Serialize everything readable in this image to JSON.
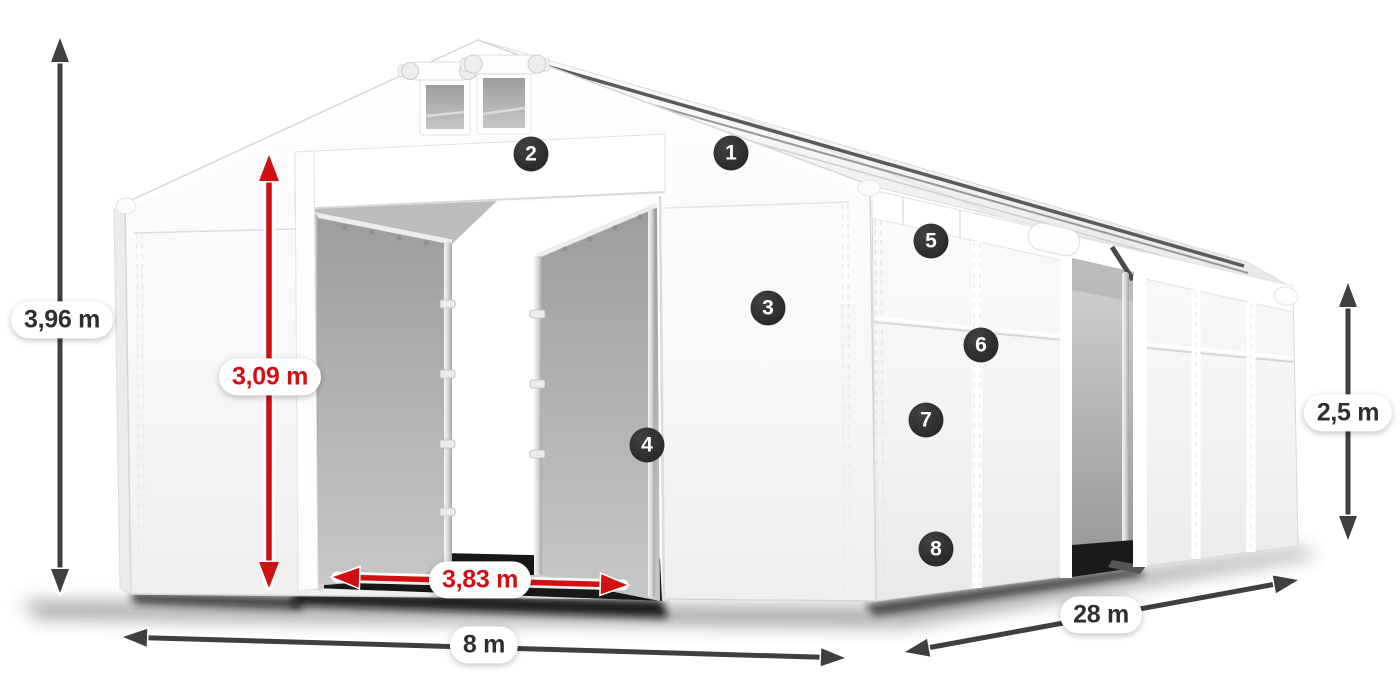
{
  "diagram": {
    "title": "Storage tent dimension diagram",
    "description": "White PVC storage tent in perspective view with measurement arrows and numbered feature markers"
  },
  "dimensions": {
    "total_height": {
      "label": "3,96 m",
      "style": "dark"
    },
    "entrance_height": {
      "label": "3,09 m",
      "style": "red"
    },
    "entrance_width": {
      "label": "3,83 m",
      "style": "red"
    },
    "gable_width": {
      "label": "8 m",
      "style": "dark"
    },
    "length": {
      "label": "28 m",
      "style": "dark"
    },
    "side_height": {
      "label": "2,5 m",
      "style": "dark"
    }
  },
  "feature_markers": [
    {
      "number": "1"
    },
    {
      "number": "2"
    },
    {
      "number": "3"
    },
    {
      "number": "4"
    },
    {
      "number": "5"
    },
    {
      "number": "6"
    },
    {
      "number": "7"
    },
    {
      "number": "8"
    }
  ],
  "colors": {
    "background": "#ffffff",
    "dimension_dark": "#3f3f3f",
    "dimension_red": "#d11013",
    "pill_text_dark": "#2f2f2f",
    "badge_background": "#2b2b2b",
    "badge_text": "#ffffff"
  }
}
